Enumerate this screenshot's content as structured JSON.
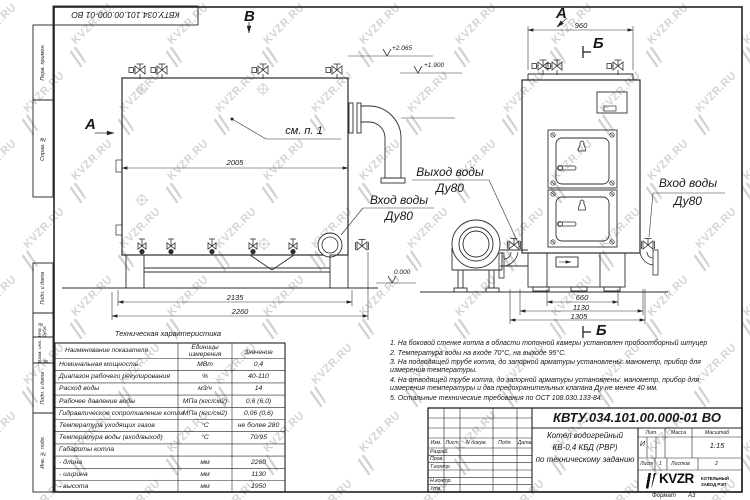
{
  "doc": {
    "number": "КВТУ.034.101.00.000-01 ВО",
    "format_label": "Формат",
    "format_value": "А3"
  },
  "stamps": {
    "top_box": "КВТУ.034.101.00.000-01 ВО",
    "left": [
      "Перв. примен.",
      "Справ. №",
      "Подп. и дата",
      "Инв. № дубл.",
      "Взам. инв. №",
      "Подп. и дата",
      "Инв. № подл."
    ]
  },
  "drawing": {
    "section_letters": {
      "a_left": "А",
      "a_right": "А",
      "b_top": "Б",
      "b_bottom": "Б",
      "v_top": "В"
    },
    "labels": {
      "see_note": "см. п. 1",
      "water_outlet": "Выход воды",
      "water_inlet": "Вход воды",
      "dn": "Ду80"
    },
    "elevations": {
      "top": "+2.065",
      "middle": "+1.900",
      "zero": "0.000"
    },
    "dims": {
      "front_width": "2005",
      "front_base": "2135",
      "front_total": "2260",
      "side_top": "960",
      "side_base": "660",
      "side_mid": "1130",
      "side_total": "1305"
    }
  },
  "table": {
    "title": "Техническая характеристика",
    "headers": [
      "Наименование показателя",
      "Единицы измерения",
      "Значение"
    ],
    "rows": [
      [
        "Номинальная мощность",
        "МВт",
        "0,4"
      ],
      [
        "Диапазон рабочего регулирования",
        "%",
        "40-110"
      ],
      [
        "Расход воды",
        "м3/ч",
        "14"
      ],
      [
        "Рабочее давление воды",
        "МПа (кгс/см2)",
        "0,6 (6,0)"
      ],
      [
        "Гидравлическое сопротивление котла",
        "МПа (кгс/см2)",
        "0,06 (0,6)"
      ],
      [
        "Температура уходящих газов",
        "°С",
        "не более 280"
      ],
      [
        "Температура воды (вход/выход)",
        "°С",
        "70/95"
      ],
      [
        "Габариты котла",
        "",
        ""
      ],
      [
        "- длина",
        "мм",
        "2260"
      ],
      [
        "- ширина",
        "мм",
        "1130"
      ],
      [
        "- высота",
        "мм",
        "1950"
      ]
    ]
  },
  "notes": {
    "items": [
      "1. На боковой стенке котла в области топочной камеры установлен пробоотборный штуцер",
      "2. Температура воды на входе 70°С, на выходе 95°С.",
      "3. На подводящей трубе котла, до запорной арматуры установлены: манометр, прибор для измерения температуры.",
      "4. На отводящей трубе котла, до запорной арматуры установлены: манометр, прибор для измерения температуры и два предохранительных клапана Ду не менее 40 мм.",
      "5. Остальные технические требования по ОСТ 108.030.133-84."
    ]
  },
  "title_block": {
    "number": "КВТУ.034.101.00.000-01 ВО",
    "name_line1": "Котел водогрейный",
    "name_line2": "КВ-0,4 КБД (РВР)",
    "name_line3": "по техническому заданию",
    "cols": {
      "izm": "Изм.",
      "list": "Лист",
      "ndoc": "N докум.",
      "podp": "Подп.",
      "data": "Дата"
    },
    "rows": {
      "razrab": "Разраб.",
      "prov": "Пров.",
      "tkontr": "Т.контр.",
      "nkontr": "Н.контр.",
      "utv": "Утв."
    },
    "lit_label": "Лит.",
    "massa_label": "Масса",
    "scale_label": "Масштаб",
    "lit_value": "И",
    "scale_value": "1:15",
    "sheet_label": "Лист",
    "sheet_value": "1",
    "sheets_label": "Листов",
    "sheets_value": "2",
    "company": {
      "logo_text": "KVZR",
      "name_line1": "КОТЕЛЬНЫЙ",
      "name_line2": "ЗАВОД РЭП"
    }
  },
  "watermark": {
    "text": "KVZR.RU"
  }
}
